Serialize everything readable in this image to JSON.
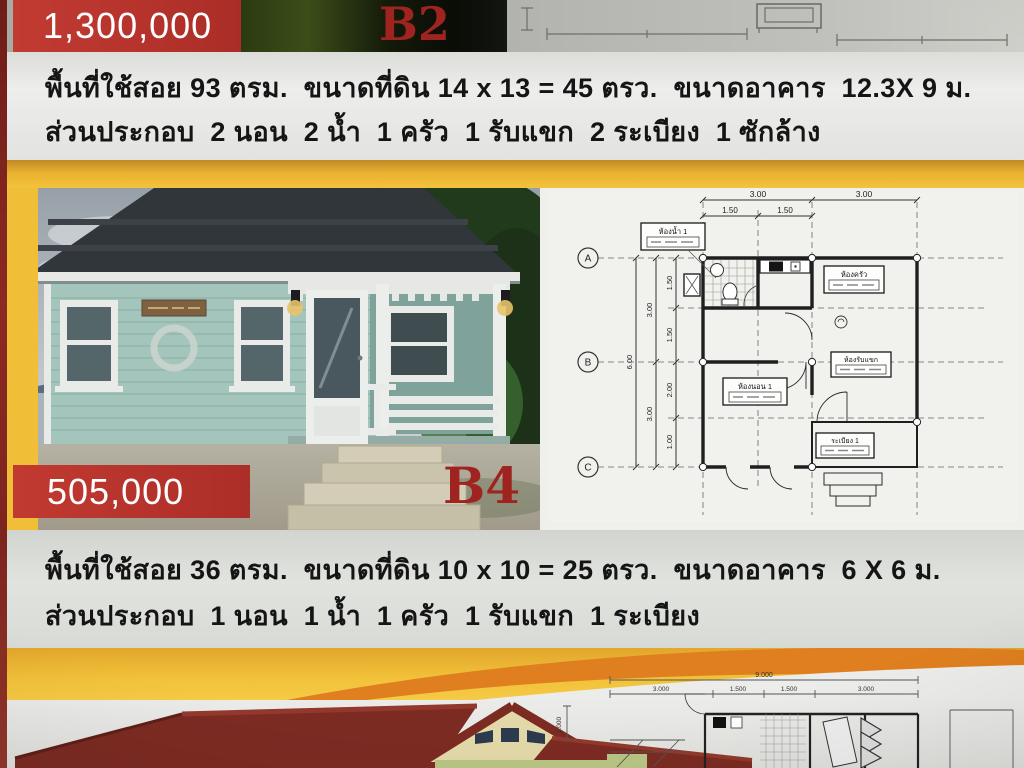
{
  "listings": [
    {
      "code": "B2",
      "price": "1,300,000",
      "spec1": "พื้นที่ใช้สอย 93 ตรม.  ขนาดที่ดิน 14 x 13 = 45 ตรว.  ขนาดอาคาร  12.3X 9 ม.",
      "spec2": "ส่วนประกอบ  2 นอน  2 น้ำ  1 ครัว  1 รับแขก  2 ระเบียง  1 ซักล้าง"
    },
    {
      "code": "B4",
      "price": "505,000",
      "spec1": "พื้นที่ใช้สอย 36 ตรม.  ขนาดที่ดิน 10 x 10 = 25 ตรว.  ขนาดอาคาร  6 X 6 ม.",
      "spec2": "ส่วนประกอบ  1 นอน  1 น้ำ  1 ครัว  1 รับแขก  1 ระเบียง"
    }
  ],
  "floorplan_b4": {
    "grid": {
      "rows": [
        "A",
        "B",
        "C"
      ]
    },
    "dims": {
      "top_overall": [
        "3.00",
        "3.00"
      ],
      "top_sub": [
        "1.50",
        "1.50"
      ],
      "left_sub": [
        "1.50",
        "1.50",
        "2.00",
        "1.00"
      ],
      "left_mid": [
        "3.00",
        "3.00"
      ],
      "left_total": "6.00"
    },
    "rooms": {
      "bath": "ห้องน้ำ 1",
      "kitchen": "ห้องครัว",
      "bedroom": "ห้องนอน 1",
      "living": "ห้องรับแขก",
      "porch": "ระเบียง 1"
    }
  },
  "floorplan_bottom": {
    "dims": {
      "overall": "9.000",
      "sub": [
        "3.000",
        "1.500",
        "1.500",
        "3.000"
      ],
      "left": "1.000"
    }
  },
  "colors": {
    "banner_red": "#b5332d",
    "code_red": "#9f2420",
    "gold": "#f0bd35",
    "orange_swoosh": "#df7f1f",
    "house_teal": "#a4c5bc",
    "roof_dark": "#31363a",
    "bottom_roof_maroon": "#7c2b22"
  }
}
